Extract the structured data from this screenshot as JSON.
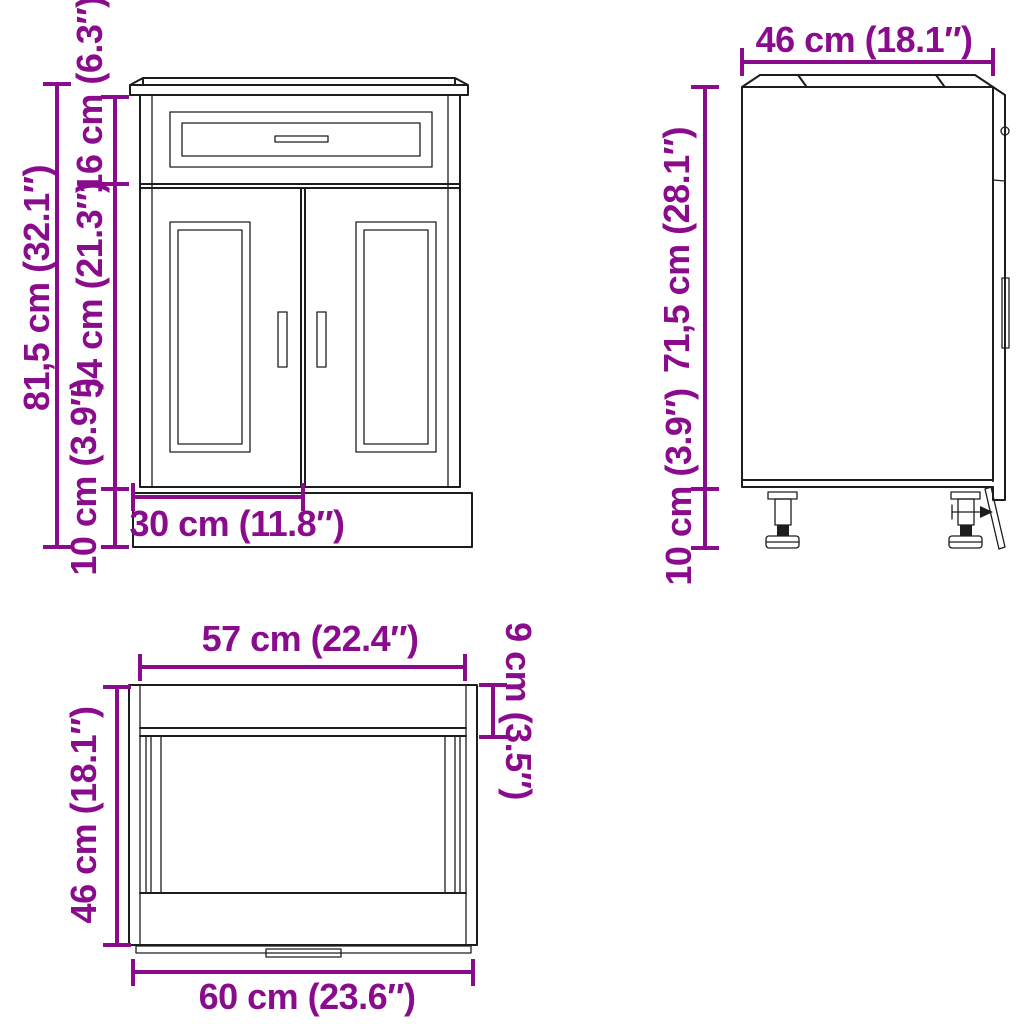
{
  "colors": {
    "dimension": "#8a0c8c",
    "line": "#1d1d1d",
    "background": "#ffffff"
  },
  "diagram": {
    "subject": "kitchen base cabinet dimension drawing",
    "views": [
      "front",
      "side",
      "top"
    ]
  },
  "views": {
    "front": {
      "name": "front-view",
      "labels": {
        "total_height": "81,5 cm (32.1″)",
        "drawer_height": "16 cm (6.3″)",
        "door_height": "54 cm (21.3″)",
        "plinth_height": "10 cm (3.9″)",
        "door_width": "30 cm (11.8″)"
      }
    },
    "side": {
      "name": "side-view",
      "labels": {
        "depth": "46 cm (18.1″)",
        "body_height": "71,5 cm (28.1″)",
        "leg_height": "10 cm (3.9″)"
      }
    },
    "top": {
      "name": "top-view",
      "labels": {
        "inner_width": "57 cm (22.4″)",
        "front_depth": "9 cm (3.5″)",
        "depth": "46 cm (18.1″)",
        "total_width": "60 cm (23.6″)"
      }
    }
  }
}
